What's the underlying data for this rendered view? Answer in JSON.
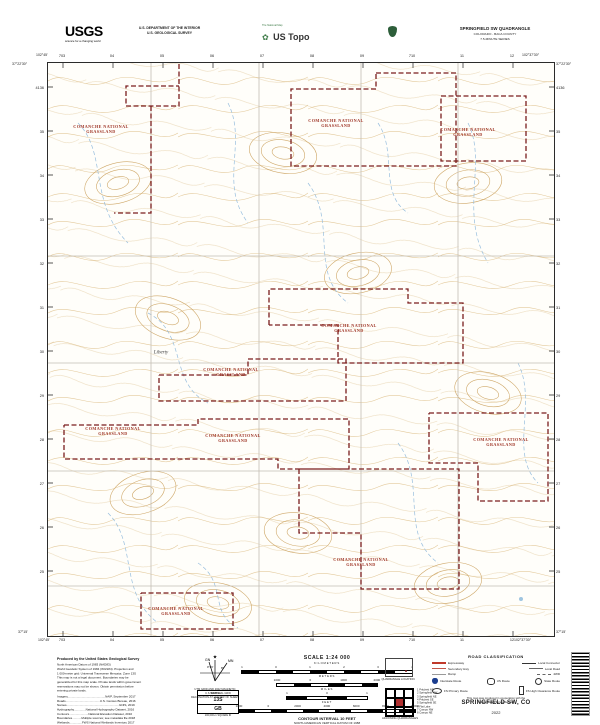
{
  "header": {
    "usgs_logo": "USGS",
    "usgs_tagline": "science for a changing world",
    "dept_line1": "U.S. DEPARTMENT OF THE INTERIOR",
    "dept_line2": "U.S. GEOLOGICAL SURVEY",
    "ustopo_tagline": "The National Map",
    "ustopo_title": "US Topo",
    "quad_title": "SPRINGFIELD SW QUADRANGLE",
    "quad_state": "COLORADO - BACA COUNTY",
    "quad_series": "7.5-MINUTE SERIES"
  },
  "map": {
    "corners": {
      "tl_lon": "102°45'",
      "tl_lat": "37°22'30″",
      "tr_lon": "102°37'30″",
      "tr_lat": "37°22'30″",
      "bl_lat": "37°15'",
      "bl_lon": "102°45'",
      "br_lon": "102°37'30″",
      "br_lat": "37°15'"
    },
    "top_ticks": [
      "703",
      "04",
      "05",
      "06",
      "07",
      "08",
      "09",
      "710",
      "11",
      "12"
    ],
    "bottom_ticks": [
      "703",
      "04",
      "05",
      "06",
      "07",
      "08",
      "09",
      "710",
      "11",
      "12"
    ],
    "left_ticks": [
      "4136",
      "35",
      "34",
      "33",
      "32",
      "31",
      "30",
      "29",
      "28",
      "27",
      "26",
      "25"
    ],
    "right_ticks": [
      "4136",
      "35",
      "34",
      "33",
      "32",
      "31",
      "30",
      "29",
      "28",
      "27",
      "26",
      "25"
    ],
    "grassland_labels": [
      {
        "x": 53,
        "y": 66,
        "l1": "COMANCHE NATIONAL",
        "l2": "GRASSLAND"
      },
      {
        "x": 288,
        "y": 60,
        "l1": "COMANCHE NATIONAL",
        "l2": "GRASSLAND"
      },
      {
        "x": 420,
        "y": 69,
        "l1": "COMANCHE NATIONAL",
        "l2": "GRASSLAND"
      },
      {
        "x": 301,
        "y": 265,
        "l1": "COMANCHE NATIONAL",
        "l2": "GRASSLAND"
      },
      {
        "x": 183,
        "y": 309,
        "l1": "COMANCHE NATIONAL",
        "l2": "GRASSLAND"
      },
      {
        "x": 65,
        "y": 368,
        "l1": "COMANCHE NATIONAL",
        "l2": "GRASSLAND"
      },
      {
        "x": 185,
        "y": 375,
        "l1": "COMANCHE NATIONAL",
        "l2": "GRASSLAND"
      },
      {
        "x": 453,
        "y": 379,
        "l1": "COMANCHE NATIONAL",
        "l2": "GRASSLAND"
      },
      {
        "x": 313,
        "y": 499,
        "l1": "COMANCHE NATIONAL",
        "l2": "GRASSLAND"
      },
      {
        "x": 128,
        "y": 548,
        "l1": "COMANCHE NATIONAL",
        "l2": "GRASSLAND"
      }
    ],
    "place_liberty": "Liberty"
  },
  "footer": {
    "produced": {
      "title": "Produced by the United States Geological Survey",
      "lines": [
        "North American Datum of 1983 (NAD83)",
        "World Geodetic System of 1984 (WGS84). Projection and",
        "1 000-meter grid: Universal Transverse Mercator, Zone 13S",
        "This map is not a legal document. Boundaries may be",
        "generalized for this map scale. Private lands within government",
        "reservations may not be shown. Obtain permission before",
        "entering private lands."
      ],
      "credits": [
        "Imagery.............................................NAIP, September 2017",
        "Roads.........................................U.S. Census Bureau, 2016",
        "Names...............................................................GNIS, 2019",
        "Hydrography..............National Hydrography Dataset, 2016",
        "Contours.......................National Elevation Dataset, 2010",
        "Boundaries...........Multiple sources; see metadata file 2018",
        "Wetlands...............FWS National Wetlands Inventory 2017",
        "Public Land Survey System..............................BLM, 2017"
      ]
    },
    "declination": {
      "star": "★",
      "gn": "GN",
      "mn": "MN",
      "gn_angle": "0°16'",
      "mn_angle": "8°",
      "caption1": "UTM GRID AND 2022 MAGNETIC NORTH",
      "caption2": "DECLINATION AT CENTER OF SHEET"
    },
    "usng": {
      "title": "U.S. NATIONAL GRID",
      "zone": "13S",
      "square": "GB",
      "caption": "100,000-m SQUARE ID"
    },
    "scale": {
      "title": "SCALE 1:24 000",
      "km_label": "KILOMETERS",
      "km": [
        "1",
        "0",
        "1",
        "2",
        "3",
        "4"
      ],
      "m_label": "METERS",
      "m": [
        "1000",
        "0",
        "1000",
        "2000"
      ],
      "mi_label": "MILES",
      "mi": [
        "1",
        "0",
        "1"
      ],
      "ft_label": "FEET",
      "ft": [
        "1000",
        "0",
        "2000",
        "4000",
        "6000",
        "8000",
        "10000"
      ],
      "ci1": "CONTOUR INTERVAL 10 FEET",
      "ci2": "NORTH AMERICAN VERTICAL DATUM OF 1988",
      "std1": "This map was produced to conform with the",
      "std2": "National Geospatial Program US Topo Product Standard, 2011."
    },
    "location_caption": "QUADRANGLE LOCATION",
    "adjoining": {
      "caption": "ADJOINING QUADRANGLES",
      "items": [
        "1 Pritchett NE",
        "2 Springfield NW",
        "3 Springfield NE",
        "4 Pritchett SE",
        "5 Springfield SE",
        "6 Flat Lake",
        "7 Campo NW",
        "8 Campo NE"
      ]
    },
    "roads": {
      "header": "ROAD CLASSIFICATION",
      "expressway": "Expressway",
      "local_connector": "Local Connector",
      "secondary": "Secondary Hwy",
      "local_road": "Local Road",
      "ramp": "Ramp",
      "fwd": "4WD",
      "interstate": "Interstate Route",
      "us": "US Route",
      "state": "State Route",
      "fs_primary": "FS Primary Route",
      "fs_high": "FS High Clearance Route",
      "coop1": "This map was produced in cooperation with the",
      "coop2": "United States Forest Service"
    },
    "title": "SPRINGFIELD SW, CO",
    "year": "2022"
  }
}
